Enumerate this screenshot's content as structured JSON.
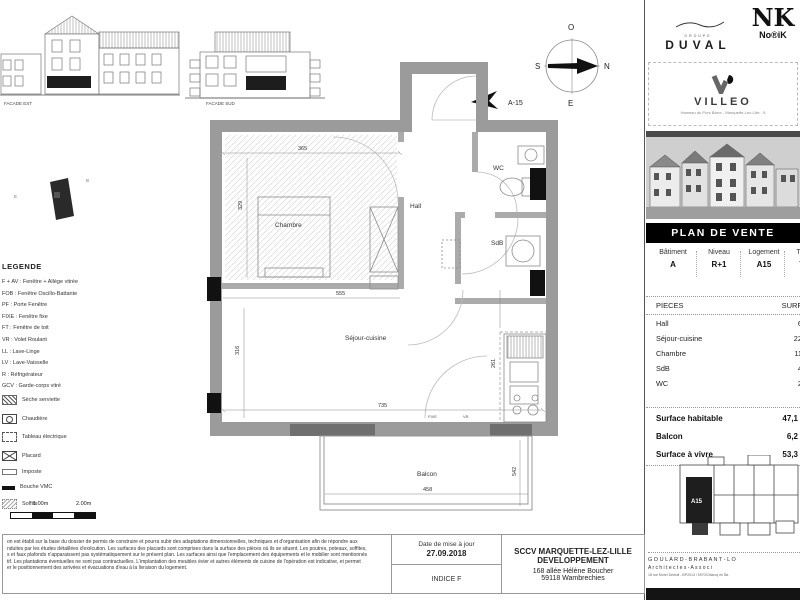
{
  "facades": {
    "est": "FACADE EST",
    "sud": "FACADE SUD"
  },
  "legend": {
    "title": "LEGENDE",
    "items": [
      "F + AV : Fenêtre + Allège vitrée",
      "FOB : Fenêtre Oscillo-Battante",
      "PF : Porte Fenêtre",
      "FIXE : Fenêtre fixe",
      "FT : Fenêtre de toit",
      "VR : Volet Roulant",
      "LL : Lave-Linge",
      "LV : Lave-Vaisselle",
      "R : Réfrigérateur",
      "GCV : Garde-corps vitré",
      "Sèche serviette",
      "Chaudière",
      "Tableau électrique",
      "Placard",
      "Imposte",
      "Bouche VMC",
      "Soffite"
    ],
    "icons": [
      "seche-serviette",
      "chaudiere",
      "tableau-electrique",
      "placard",
      "imposte",
      "bouche-vmc",
      "soffite"
    ],
    "scale_labels": [
      "1.00m",
      "2.00m"
    ]
  },
  "plan": {
    "rooms": {
      "chambre": "Chambre",
      "hall": "Hall",
      "wc": "WC",
      "sdb": "SdB",
      "sejour": "Séjour-cuisine",
      "balcon": "Balcon"
    },
    "dims": {
      "d365": "365",
      "d329": "329",
      "d555": "555",
      "d316": "316",
      "d735": "735",
      "d261": "261",
      "d458": "458",
      "d542": "542",
      "w_fixe": "FIXE",
      "w_vr": "VR"
    },
    "unit_flag": "A-15",
    "compass": {
      "top": "O",
      "left": "S",
      "right": "N",
      "bottom": "E"
    },
    "site_letters": {
      "right": "B",
      "left": "E"
    }
  },
  "brand": {
    "group": "GROUPE",
    "duval": "DUVAL",
    "nk": "NK",
    "norik": "No®iK",
    "villeo": "VILLEO",
    "villeo_sub": "Hameau du Pont Blanc - Marquette-Lez-Lille - 5"
  },
  "sale": {
    "banner": "PLAN DE VENTE",
    "header": {
      "batiment_label": "Bâtiment",
      "batiment": "A",
      "niveau_label": "Niveau",
      "niveau": "R+1",
      "logement_label": "Logement",
      "logement": "A15",
      "type_label": "Type",
      "type": "T2"
    },
    "pieces_title": "PIECES",
    "surfaces_title": "SURFACES",
    "pieces": [
      {
        "name": "Hall",
        "surface": "6,7"
      },
      {
        "name": "Séjour-cuisine",
        "surface": "22,6"
      },
      {
        "name": "Chambre",
        "surface": "11,4"
      },
      {
        "name": "SdB",
        "surface": "4,3"
      },
      {
        "name": "WC",
        "surface": "2,0"
      }
    ],
    "summary": [
      {
        "label": "Surface habitable",
        "value": "47,1"
      },
      {
        "label": "Balcon",
        "value": "6,2"
      },
      {
        "label": "Surface à vivre",
        "value": "53,3"
      }
    ],
    "keyplan_unit": "A15",
    "architect": {
      "line1": "G O U L A R D -   B R A B A N T - L O",
      "line2": "A r c h i t e c t e s    -    A s s o c i",
      "line3": "18 rue Morel Dewulf - BP2013 / 59703 Marcq en Ba"
    }
  },
  "titleblock": {
    "date_label": "Date de mise à jour",
    "date_value": "27.09.2018",
    "indice": "INDICE F",
    "company1": "SCCV MARQUETTE-LEZ-LILLE",
    "company2": "DEVELOPPEMENT",
    "address1": "168 allée Hélène Boucher",
    "address2": "59118 Wambrechies",
    "disclaimer": [
      "on est établi sur la base du dossier de permis de construire et pourra subir des adaptations dimensionnelles, techniques et d'organisation afin de répondre aux",
      "nduites par les études détaillées d'exécution. Les surfaces des placards sont comprises dans la surface des pièces où ils se situent. Les poutres, poteaux, soffites,",
      "s et faux plafonds n'apparaissent pas systématiquement sur le présent plan. Les surfaces ainsi que l'emplacement des équipements et le mobilier sont mentionnés",
      "tif. Les plantations éventuelles ne sont pas contractuelles. L'implantation des meubles évier et autres éléments de cuisine de l'opération est indicative, et permet",
      "er le positionnement des arrivées et évacuations d'eau à la livraison du logement."
    ]
  }
}
